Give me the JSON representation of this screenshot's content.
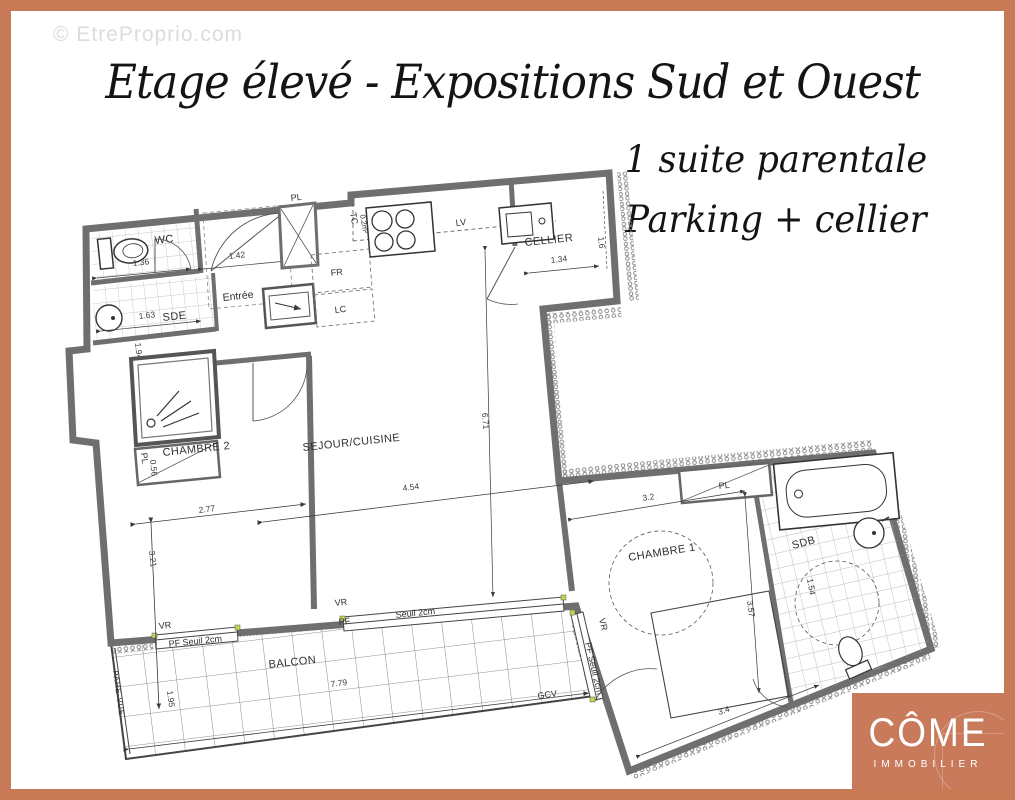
{
  "frame_color": "#c87a57",
  "watermark": "© EtreProprio.com",
  "title": "Etage élevé - Expositions Sud et Ouest",
  "subtitles": {
    "line1": "1 suite parentale",
    "line2": "Parking + cellier"
  },
  "logo": {
    "name": "CÔME",
    "tagline": "IMMOBILIER"
  },
  "plan": {
    "rooms": {
      "wc": "WC",
      "sde": "SDE",
      "entree": "Entrée",
      "cellier": "CELLIER",
      "chambre2": "CHAMBRE 2",
      "sejour": "SEJOUR/CUISINE",
      "chambre1": "CHAMBRE 1",
      "sdb": "SDB",
      "balcon": "BALCON"
    },
    "closets": {
      "pl": "PL"
    },
    "appliances": {
      "fr": "FR",
      "lc": "LC",
      "lv": "LV",
      "tc": "TC",
      "tc_area": "0.2m²"
    },
    "dims": {
      "wc_w": "1.36",
      "entree_w": "1.42",
      "sde_w": "1.63",
      "sde_h": "1.94",
      "pl2_d": "0.56",
      "cellier_w": "1.34",
      "cellier_d": "1.6",
      "sejour_w": "4.54",
      "sejour_h": "6.71",
      "chambre2_w": "2.77",
      "chambre2_h": "3.21",
      "chambre1_w": "3.2",
      "chambre1_h": "3.57",
      "chambre1_w2": "3.4",
      "sdb_d": "1.54",
      "balcon_w": "7.79",
      "balcon_d": "1.95"
    },
    "openings": {
      "vr": "VR",
      "pf": "PF",
      "seuil": "Seuil 2cm",
      "pf_seuil": "PF Seuil 2cm"
    },
    "outdoor": {
      "gcv": "GCV",
      "pare_vue": "PARE-VUE"
    }
  }
}
